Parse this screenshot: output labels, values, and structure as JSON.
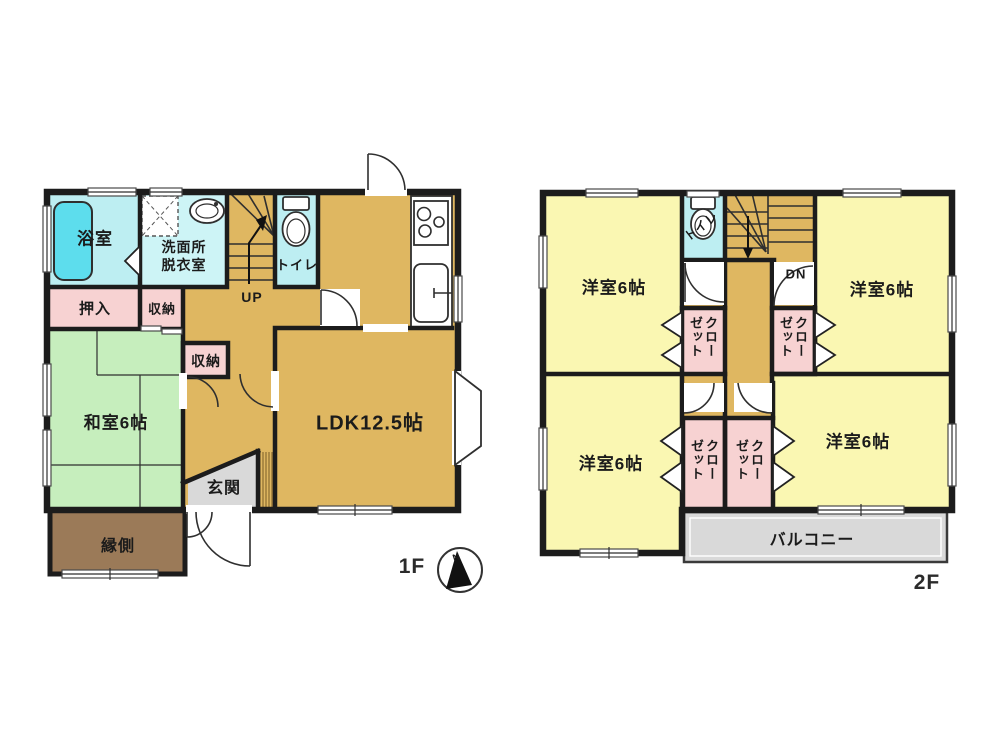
{
  "colors": {
    "wall": "#1c1c1c",
    "ldk_hall_stairs": "#dfb761",
    "western_room": "#faf7b2",
    "closet_pink": "#f7d2d2",
    "wet_area_cyan": "#bdeef2",
    "washroom_cyan": "#cdf4f6",
    "tatami_green": "#c6eebd",
    "veranda_brown": "#9b7a58",
    "entrance_balcony_gray": "#d9d9d9",
    "bathtub": "#5ddded"
  },
  "floor1": {
    "label": "1F",
    "bath": "浴室",
    "washroom_line1": "洗面所",
    "washroom_line2": "脱衣室",
    "toilet": "トイレ",
    "stairs": "UP",
    "closet_oshiire": "押入",
    "storage_top": "収納",
    "storage_mid": "収納",
    "tatami_room": "和室6帖",
    "ldk": "LDK12.5帖",
    "entrance": "玄関",
    "veranda": "縁側"
  },
  "floor2": {
    "label": "2F",
    "toilet": "トイレ",
    "stairs": "DN",
    "room_top_left": "洋室6帖",
    "room_top_right": "洋室6帖",
    "room_bottom_left": "洋室6帖",
    "room_bottom_right": "洋室6帖",
    "closet": "クローゼット",
    "balcony": "バルコニー"
  },
  "compass": {
    "north": "N"
  }
}
